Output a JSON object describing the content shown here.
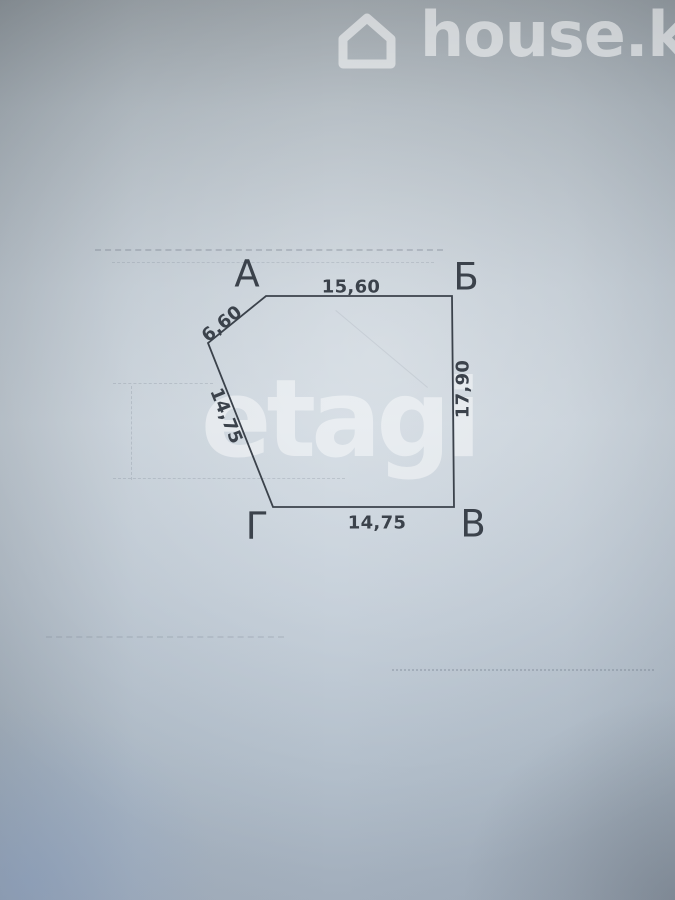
{
  "watermarks": {
    "top": {
      "label": "house.kg",
      "icon": "house-outline-icon",
      "color": "rgba(255,255,255,0.52)"
    },
    "center": {
      "label": "etagi",
      "color": "rgba(255,255,255,0.45)"
    }
  },
  "plan": {
    "type": "land-plot-boundary-outline",
    "ink_color": "#3b424b",
    "stroke_width": 1.8,
    "polygon_points": [
      [
        266,
        296
      ],
      [
        452,
        296
      ],
      [
        454,
        507
      ],
      [
        273,
        507
      ],
      [
        208,
        343
      ]
    ],
    "vertex_labels": [
      {
        "text": "А",
        "x": 247,
        "y": 274
      },
      {
        "text": "Б",
        "x": 466,
        "y": 277
      },
      {
        "text": "В",
        "x": 473,
        "y": 524
      },
      {
        "text": "Г",
        "x": 257,
        "y": 526
      }
    ],
    "edge_labels": [
      {
        "text": "15,60",
        "x": 351,
        "y": 287,
        "rotate": 0
      },
      {
        "text": "6,60",
        "x": 222,
        "y": 324,
        "rotate": -39
      },
      {
        "text": "14,75",
        "x": 226,
        "y": 416,
        "rotate": 68
      },
      {
        "text": "17,90",
        "x": 463,
        "y": 389,
        "rotate": -90
      },
      {
        "text": "14,75",
        "x": 377,
        "y": 523,
        "rotate": 0
      }
    ],
    "edges": [
      {
        "from": "А",
        "to": "Б",
        "length": "15,60"
      },
      {
        "from": "Б",
        "to": "В",
        "length": "17,90"
      },
      {
        "from": "Г",
        "to": "В",
        "length": "14,75"
      },
      {
        "from": "Г",
        "to": "corner-5",
        "length": "14,75"
      },
      {
        "from": "corner-5",
        "to": "А",
        "length": "6,60"
      }
    ]
  }
}
